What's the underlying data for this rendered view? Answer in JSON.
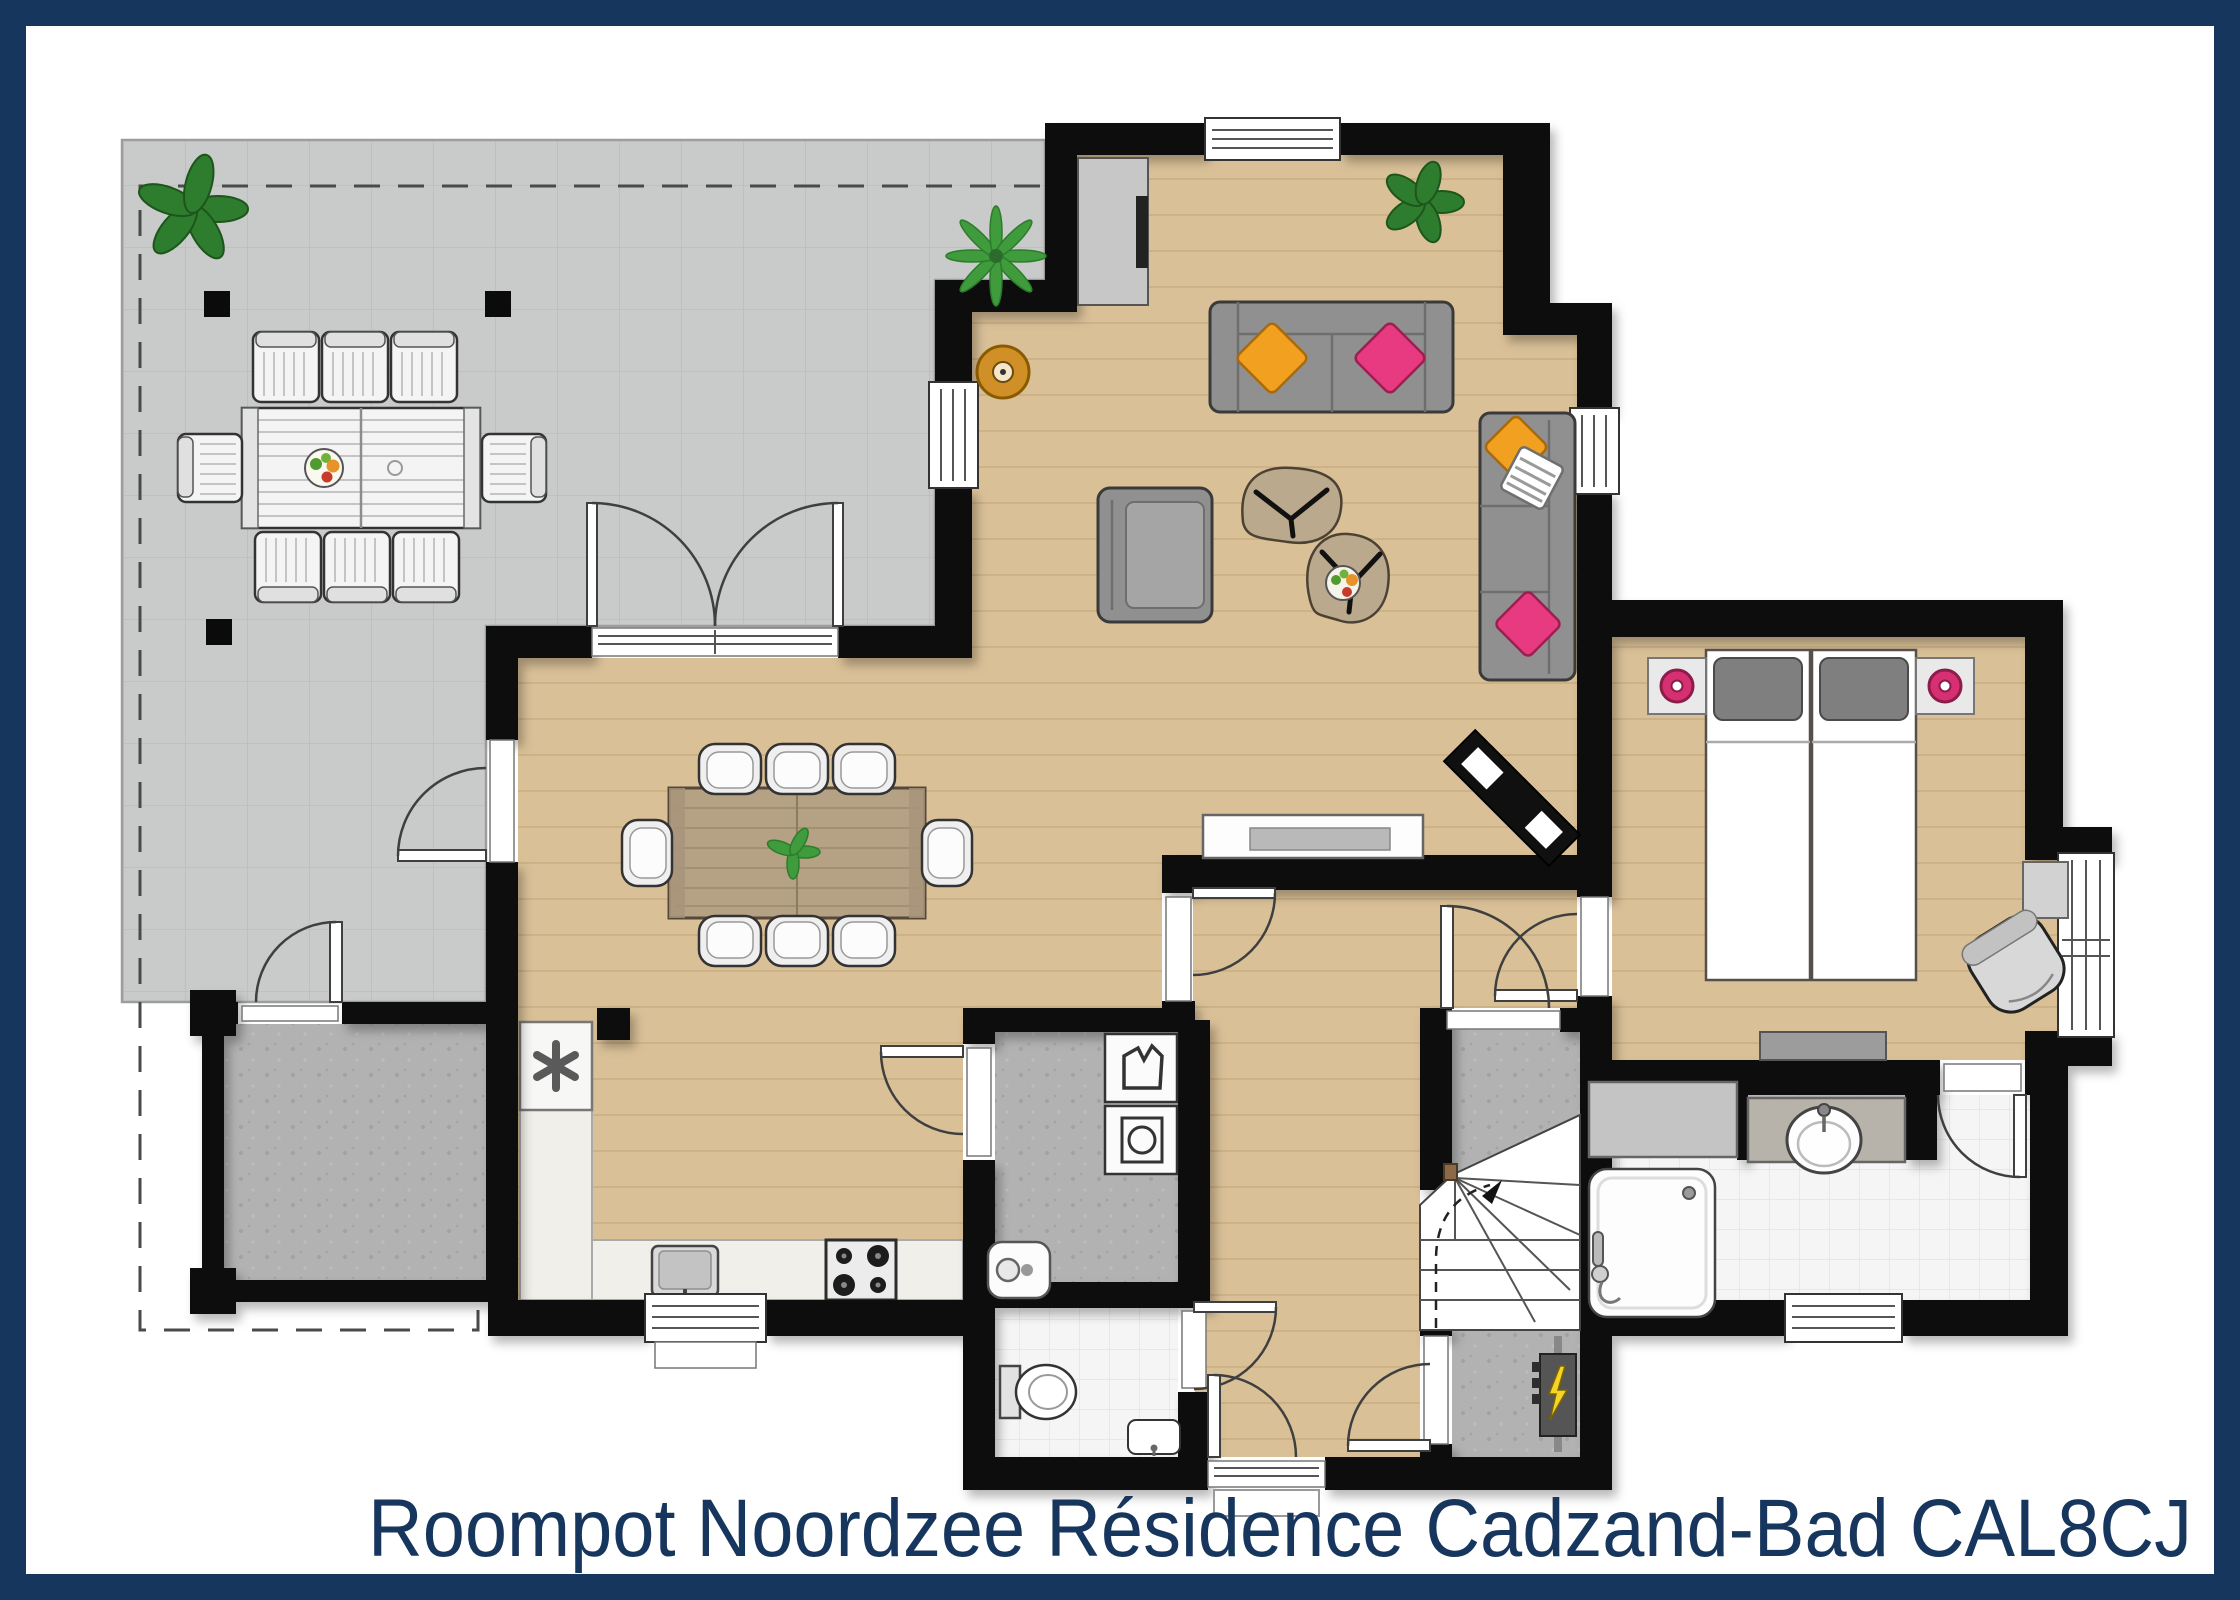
{
  "title": "Roompot Noordzee Résidence Cadzand-Bad CAL8CJ",
  "colors": {
    "frame": "#17365d",
    "title": "#17365d",
    "wall": "#0b0b0b",
    "wood": "#d9c097",
    "wood_line": "#c3a379",
    "terrace": "#c9caca",
    "terrace_line": "#bcbdbd",
    "terrace_edge": "#9d9d9d",
    "concrete": "#b2b2b2",
    "concrete_dot": "#a2a2a2",
    "tile": "#f5f5f5",
    "tile_line": "#e3e3e3",
    "counter": "#f1efe9",
    "white_furn": "#f4f4f4",
    "sofa": "#909090",
    "sofa_dark": "#3a3a3a",
    "pillow_orange": "#f2a01f",
    "pillow_pink": "#e83a80",
    "lamp_pink": "#d62f72",
    "plant": "#2e7c2d",
    "plant_light": "#3f9b3c",
    "table_tan": "#baa98c",
    "dining_wood": "#b5a284",
    "outline": "#333333",
    "door": "#3f3f3f",
    "dash": "#4a4a4a",
    "bolt": "#f5d327"
  },
  "icons": {
    "freezer": "asterisk",
    "meter_box": "lightning-bolt",
    "washer": "wash-symbol",
    "dryer": "drum-circle"
  }
}
